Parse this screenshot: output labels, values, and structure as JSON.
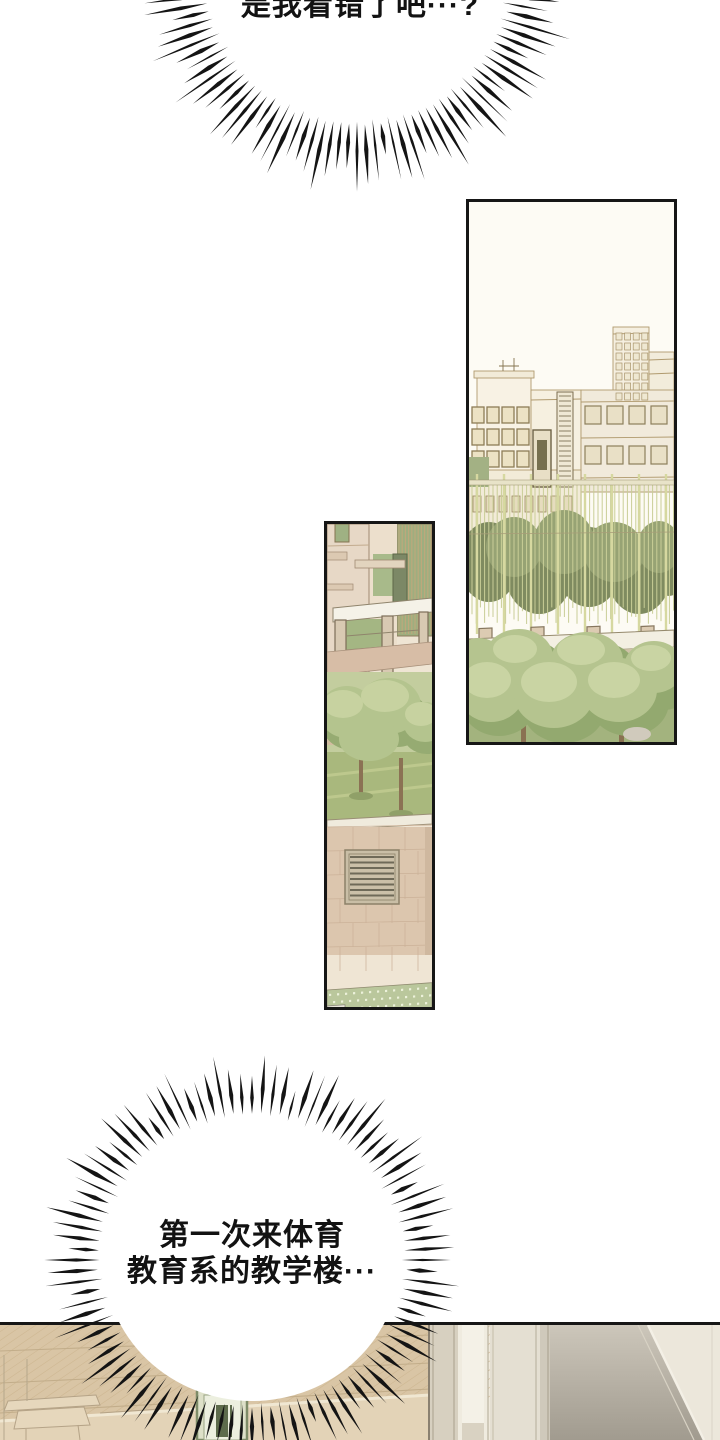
{
  "page": {
    "background": "#ffffff",
    "ink": "#141414",
    "panel_border": "#161616"
  },
  "speech": {
    "top_bubble": {
      "style": "spiky-burst",
      "text": "是我看错了吧···?"
    },
    "bottom_bubble": {
      "style": "spiky-burst",
      "line1": "第一次来体育",
      "line2": "教育系的教学楼···"
    }
  },
  "panels": {
    "wide_view": {
      "alt": "wide view of campus buildings behind a slatted fence with a row of green trees"
    },
    "narrow_view": {
      "alt": "close view of building entrance canopy, trees on a lawn, tiled wall with vent, walkway and steps"
    },
    "hallway": {
      "alt": "top edge of interior hallway panel with tan ceiling, green-framed sign and door panels"
    }
  },
  "colors": {
    "building_line": "#b9a476",
    "building_fill": "#f7f1e3",
    "foliage": "#b5c48f",
    "foliage_dark": "#95aa72",
    "fence_bar": "#c9ce97",
    "wall_tile": "#dcc6ae",
    "ceiling_tan": "#d9c5a5",
    "sign_green": "#7e8c68",
    "step_gray": "#8f8a7c"
  }
}
